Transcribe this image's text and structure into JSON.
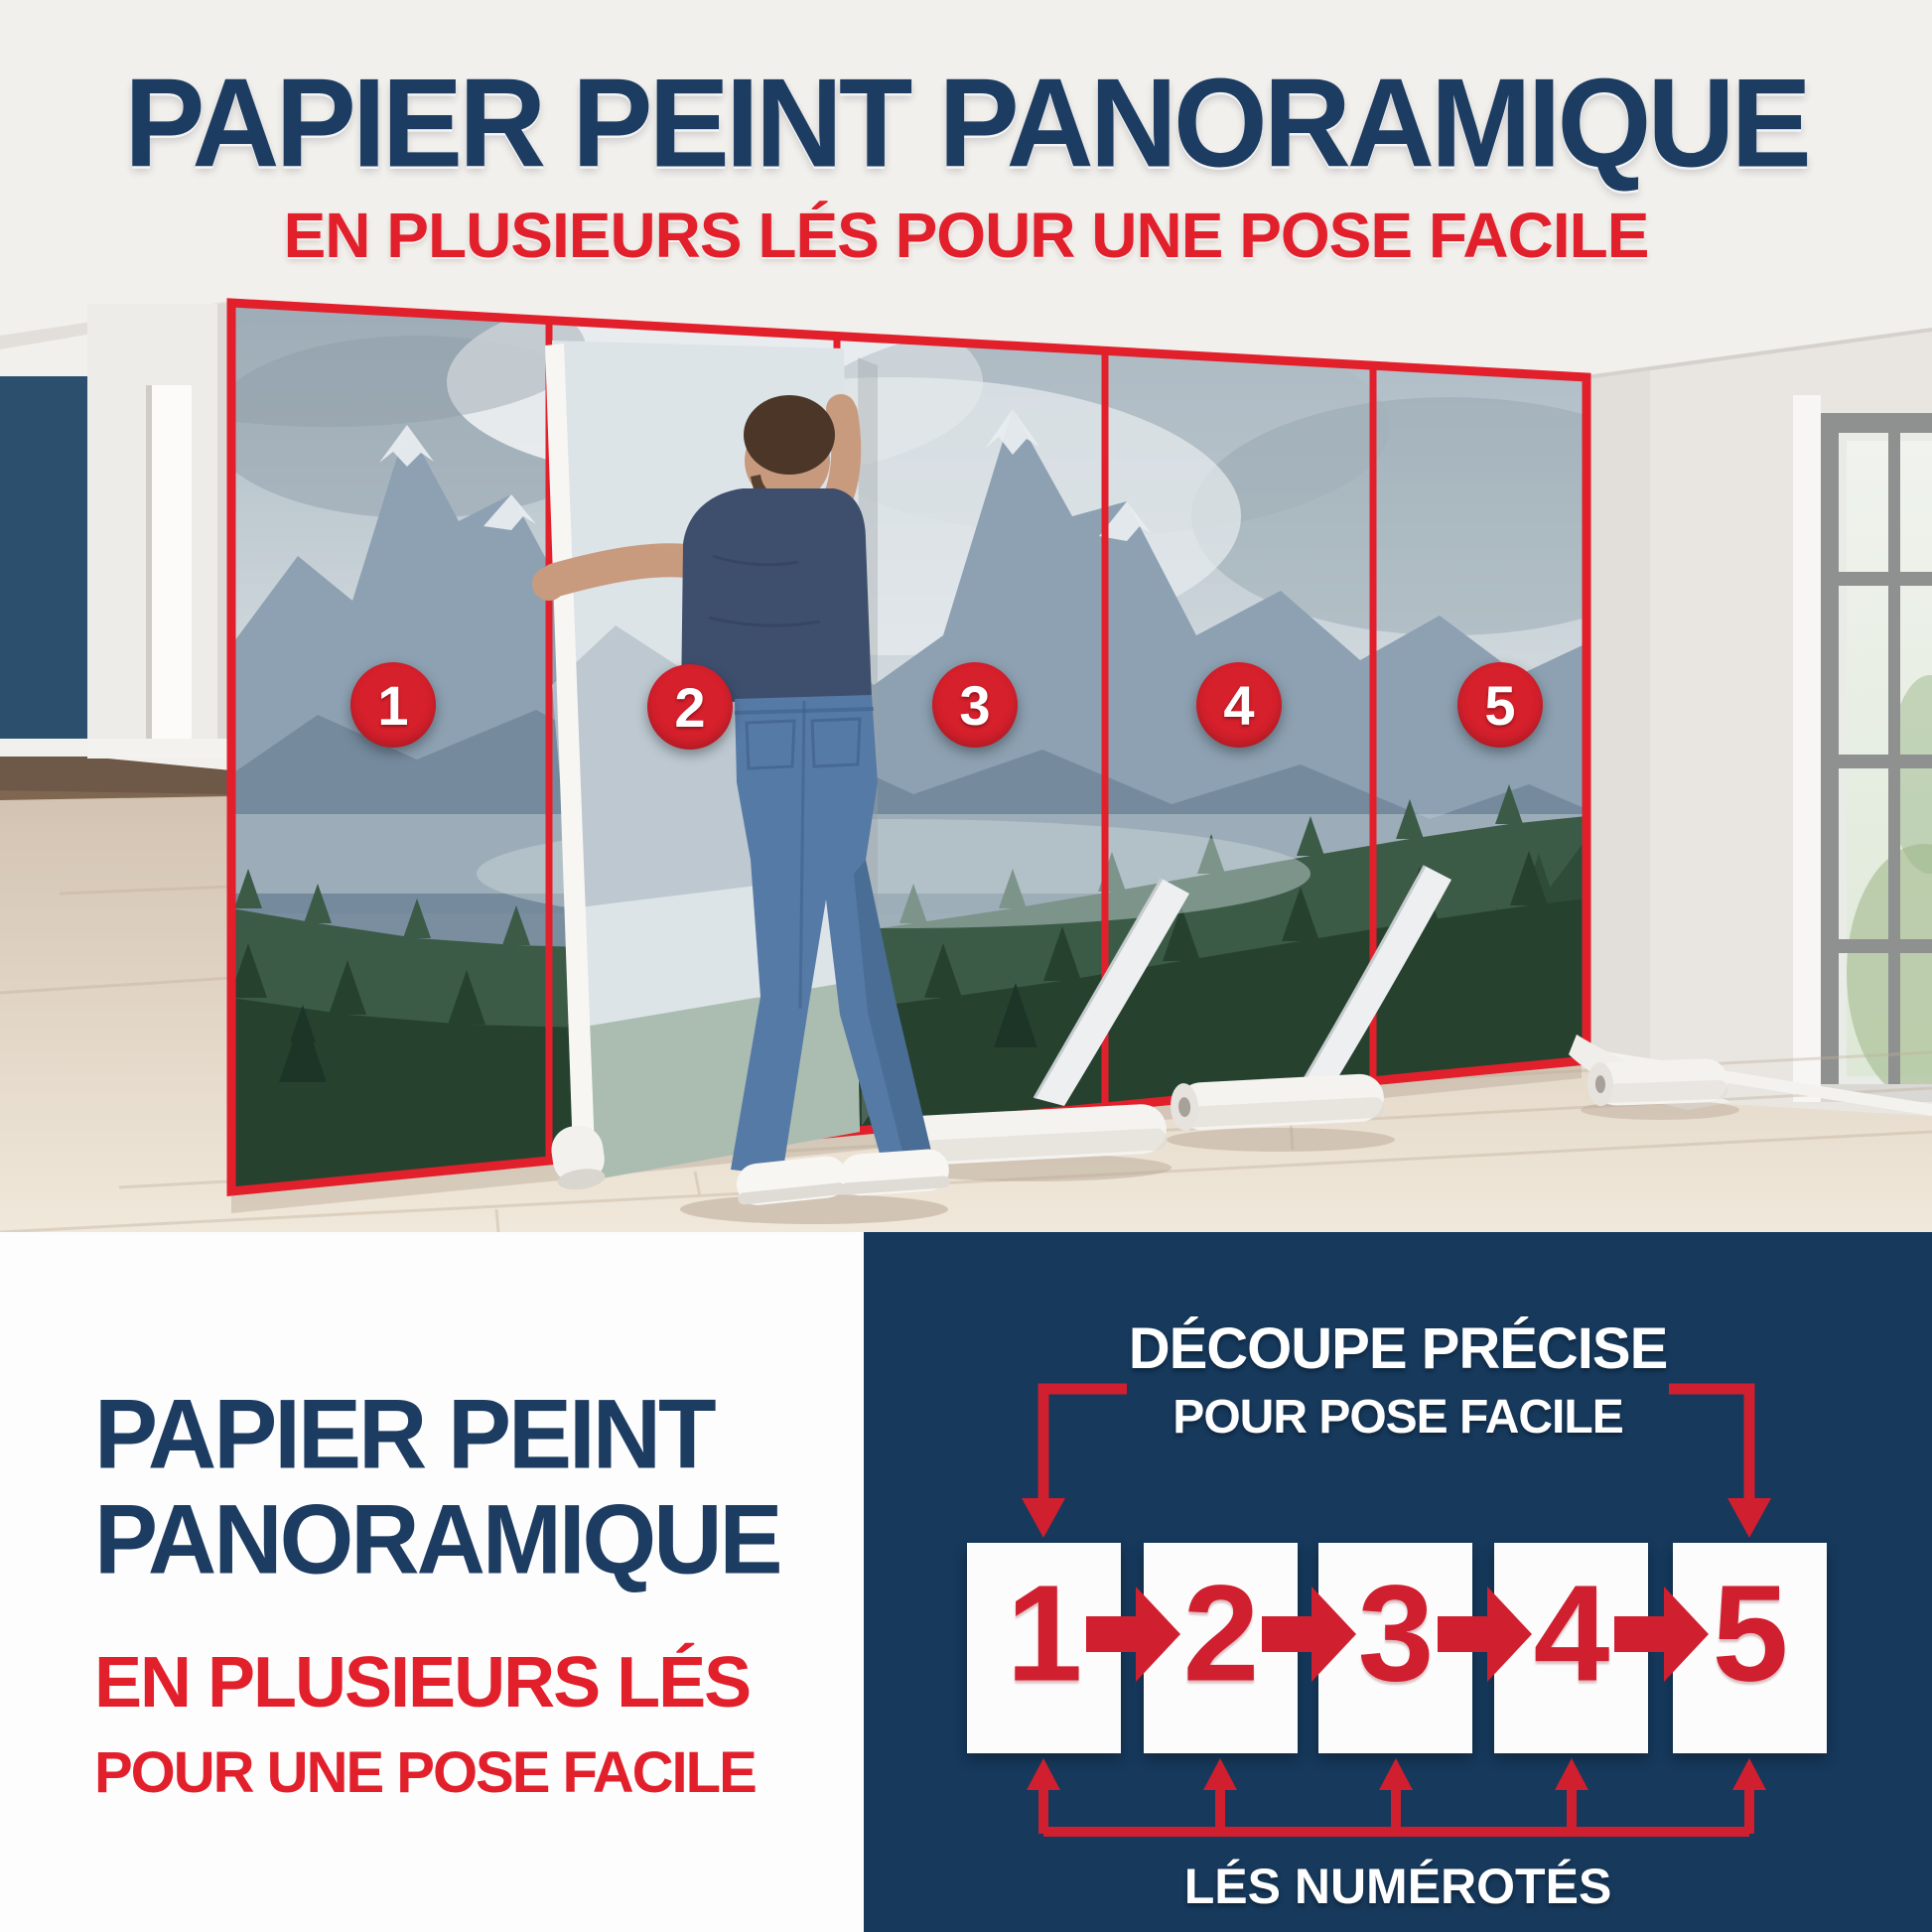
{
  "header": {
    "title": "PAPIER PEINT PANORAMIQUE",
    "subtitle": "EN PLUSIEURS LÉS POUR UNE POSE FACILE"
  },
  "photo": {
    "description_icons": [
      "mountain-forest-mural",
      "installer-man",
      "wallpaper-rolls",
      "window",
      "numbered-panel-markers"
    ],
    "panel_numbers": [
      "1",
      "2",
      "3",
      "4",
      "5"
    ]
  },
  "bottom_left": {
    "title_line1": "PAPIER PEINT",
    "title_line2": "PANORAMIQUE",
    "subtitle_line1": "EN PLUSIEURS LÉS",
    "subtitle_line2": "POUR UNE POSE FACILE"
  },
  "diagram": {
    "heading_line1": "DÉCOUPE PRÉCISE",
    "heading_line2": "POUR POSE FACILE",
    "strip_numbers": [
      "1",
      "2",
      "3",
      "4",
      "5"
    ],
    "footer": "LÉS NUMÉROTÉS"
  },
  "colors": {
    "navy_text": "#1d3c62",
    "red_accent": "#e2202c",
    "diagram_red": "#d01f2e",
    "panel_navy_bg": "#16395c",
    "circle_red": "#d6202c",
    "border_red": "#e2202c"
  }
}
